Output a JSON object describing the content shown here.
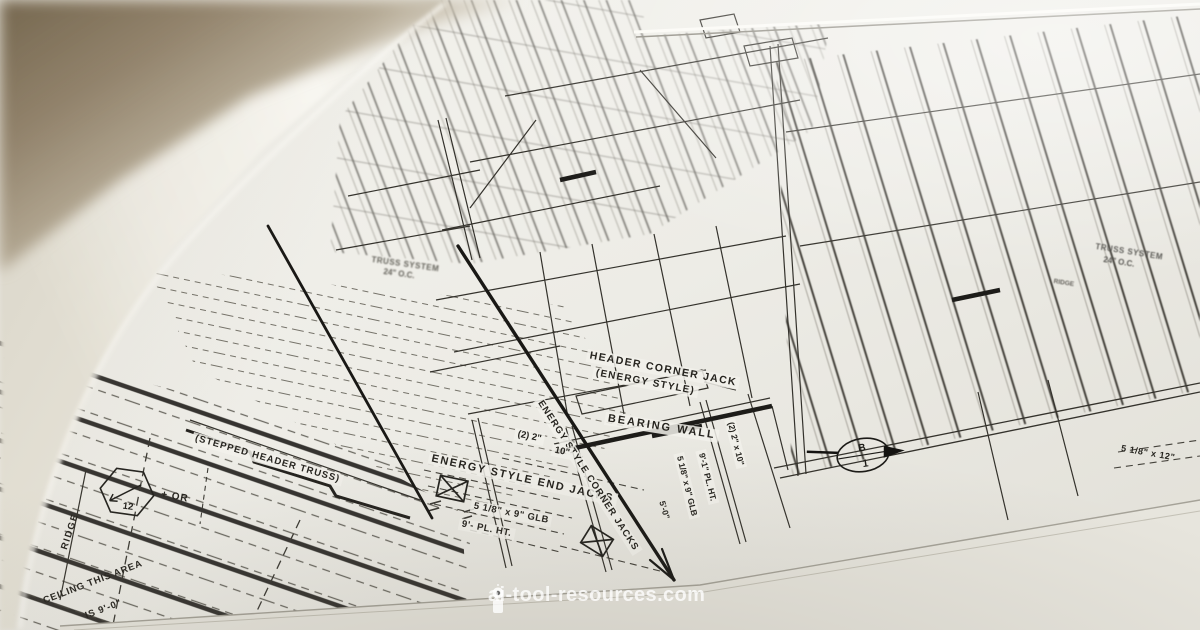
{
  "labels": {
    "header_corner_jack": "HEADER CORNER JACK",
    "energy_style": "(ENERGY STYLE)",
    "bearing_wall": "BEARING WALL",
    "end_jacks": "ENERGY STYLE END JACKS",
    "corner_jacks": "ENERGY STYLE CORNER JACKS",
    "stepped_header_truss": "(STEPPED HEADER TRUSS)",
    "truss_system": "TRUSS SYSTEM",
    "truss_spacing": "24\" O.C.",
    "truss_system_right": "TRUSS SYSTEM",
    "truss_spacing_right": "24\" O.C.",
    "ridge": "RIDGE",
    "ridge_small": "RIDGE",
    "ceiling_area_1": "CEILING THIS AREA",
    "ceiling_area_2": "IS 9'-0\"",
    "dim_2_2": "(2) 2\"",
    "dim_10": "10\"",
    "glb_9": "5 1/8\" x 9\" GLB",
    "pl_ht": "9'- PL. HT.",
    "dim_2_2x10": "(2) 2\" x 10\"",
    "glb_9_vert": "5 1/8\" x 9\" GLB",
    "pl_ht_vert": "9'-1\" PL. HT.",
    "dim_5_0": "5'-0\"",
    "glb_12": "5 1/8\" x 12\"",
    "plus_or": "+ OR",
    "pitch_value": "12",
    "detail_letter": "B",
    "detail_number": "1"
  },
  "watermark": {
    "text": "ai-tool-resources.com"
  },
  "colors": {
    "paper": "#f2f1eb",
    "ink": "#2f2d28",
    "table": "#8a7b63",
    "watermark": "#ffffff"
  }
}
